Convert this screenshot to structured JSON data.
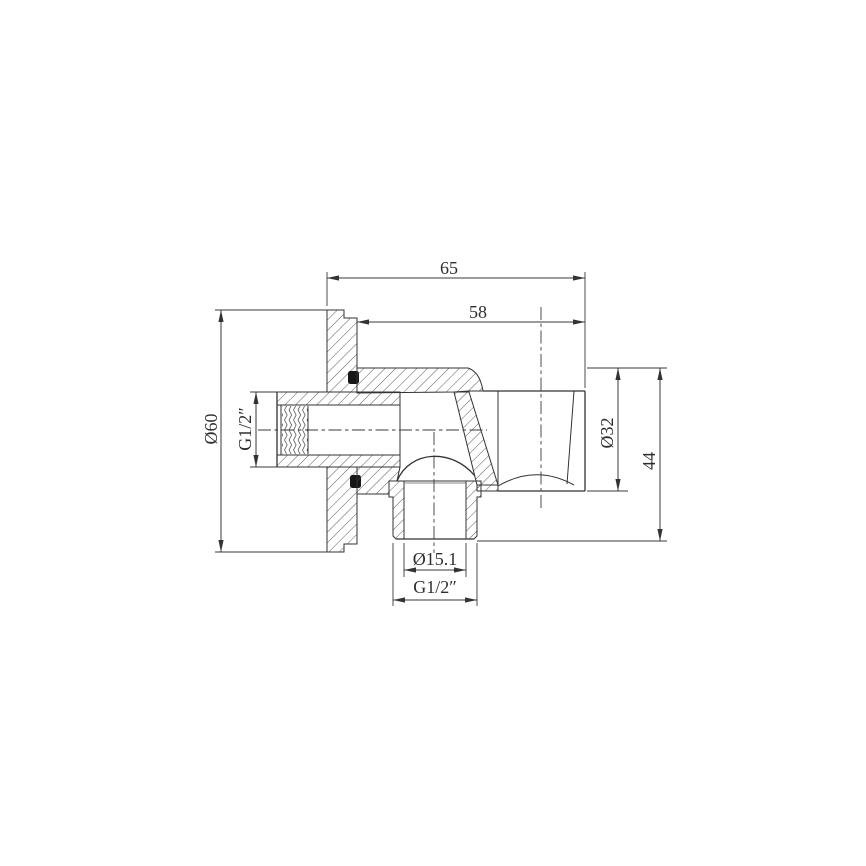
{
  "page": {
    "background": "#ffffff",
    "line_color": "#333333"
  },
  "drawing": {
    "kind": "sectional technical drawing",
    "dimensions": {
      "overall_width": "65",
      "body_width": "58",
      "flange_diameter": "Ø60",
      "inlet_thread": "G1/2″",
      "holder_diameter": "Ø32",
      "overall_height": "44",
      "outlet_bore_diameter": "Ø15.1",
      "outlet_thread": "G1/2″"
    }
  }
}
